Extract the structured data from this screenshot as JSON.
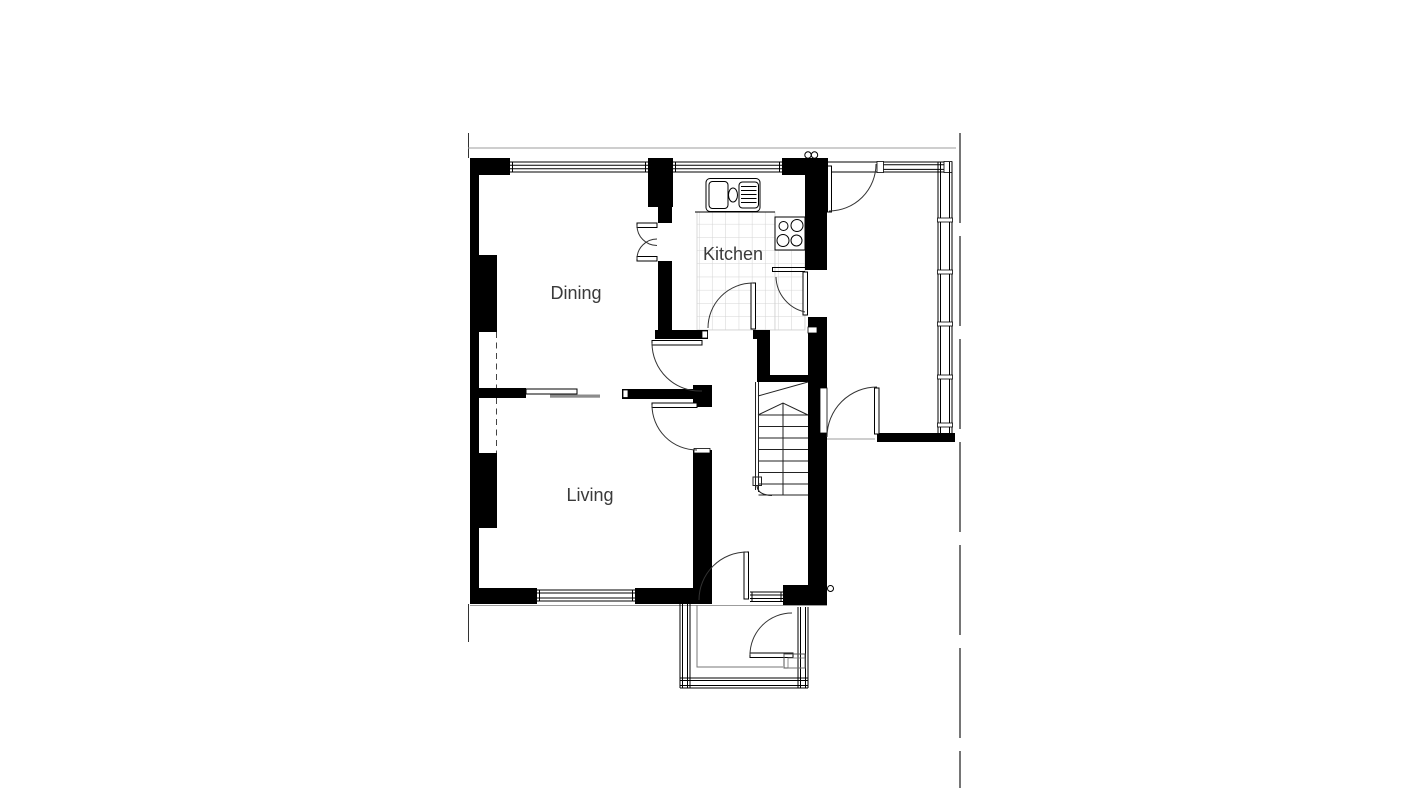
{
  "plan": {
    "rooms": [
      {
        "key": "dining",
        "label": "Dining"
      },
      {
        "key": "kitchen",
        "label": "Kitchen"
      },
      {
        "key": "living",
        "label": "Living"
      }
    ],
    "fixtures": {
      "sink": "double-sink-with-drainer",
      "stove": "four-burner-hob",
      "stairs": "staircase-with-winders",
      "floor": "tiled-kitchen-floor"
    },
    "colors": {
      "wall": "#000000",
      "tile_line": "#cfcfcf",
      "label_text": "#3a3a3a",
      "door_track": "#8c8c8c",
      "boundary_line": "#757575",
      "ground_line": "#9c9c9c"
    }
  }
}
